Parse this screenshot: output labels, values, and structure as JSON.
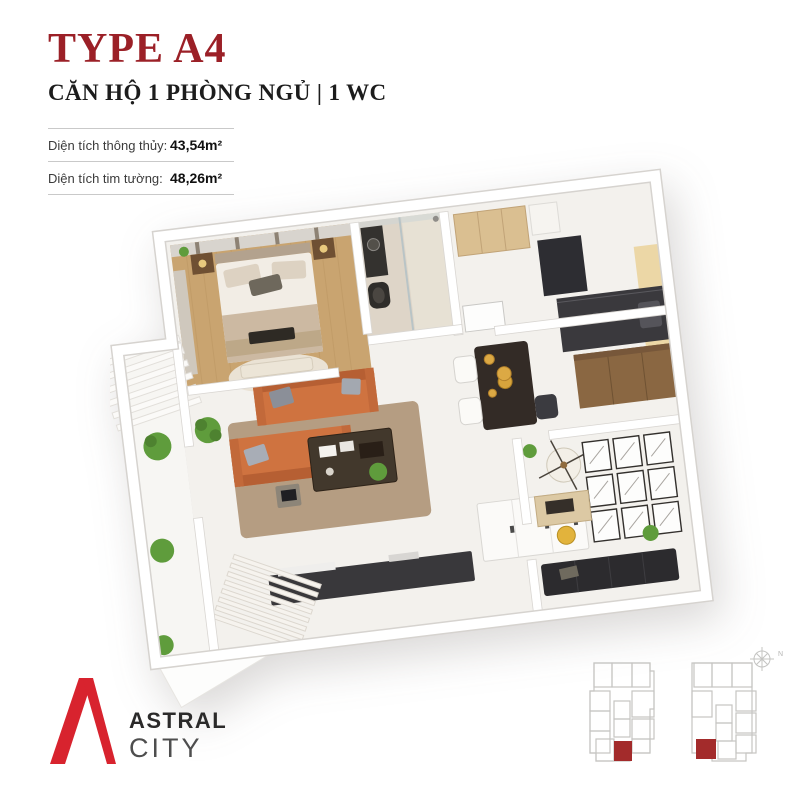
{
  "header": {
    "title": "TYPE A4",
    "subtitle": "CĂN HỘ 1 PHÒNG NGỦ | 1 WC"
  },
  "specs": {
    "rows": [
      {
        "label": "Diện tích thông thủy:",
        "value": "43,54m²"
      },
      {
        "label": "Diện tích tim tường:",
        "value": "48,26m²"
      }
    ]
  },
  "logo": {
    "line1": "ASTRAL",
    "line2": "CITY"
  },
  "keyplans": {
    "compass_label": "N"
  },
  "colors": {
    "title_red": "#9b2027",
    "logo_red": "#d8232e",
    "keyplan_red": "#a32b2b",
    "sofa_orange": "#cf7340",
    "wood_floor": "#c9a470",
    "rug_tan": "#b59d82",
    "plant_green": "#5f9c3c",
    "dark_furniture": "#35343a"
  }
}
